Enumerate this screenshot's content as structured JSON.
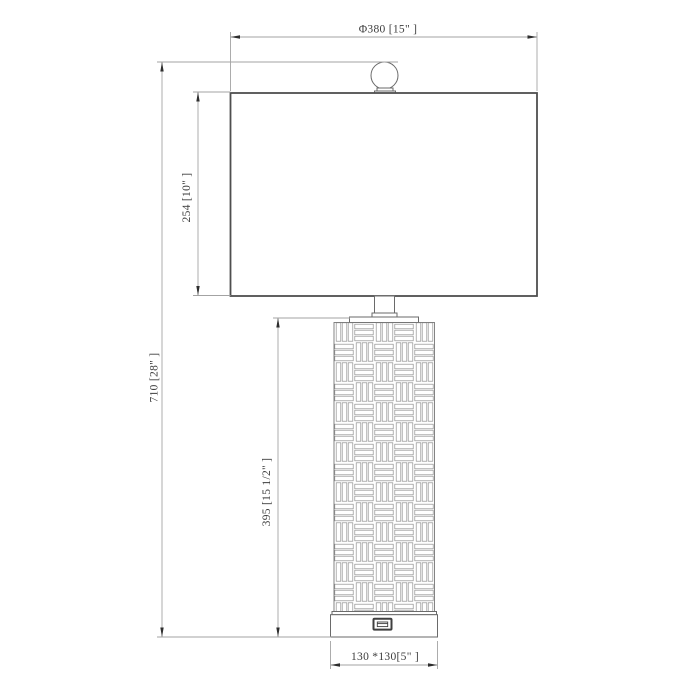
{
  "drawing": {
    "type": "technical-dimension-drawing",
    "subject": "table lamp with basket-weave body, ball finial and USB port in base",
    "units": "mm [inches]",
    "labels": {
      "shade_diameter": "Φ380 [15\" ]",
      "total_height": "710 [28\" ]",
      "shade_height": "254 [10\" ]",
      "body_height": "395 [15 1/2\" ]",
      "base_size": "130 *130[5\" ]"
    },
    "colors": {
      "background": "#ffffff",
      "object_line": "#5a5a5a",
      "dimension_line": "#a3a3a3",
      "arrow": "#2e2e2e",
      "text": "#3d3d3d"
    }
  }
}
